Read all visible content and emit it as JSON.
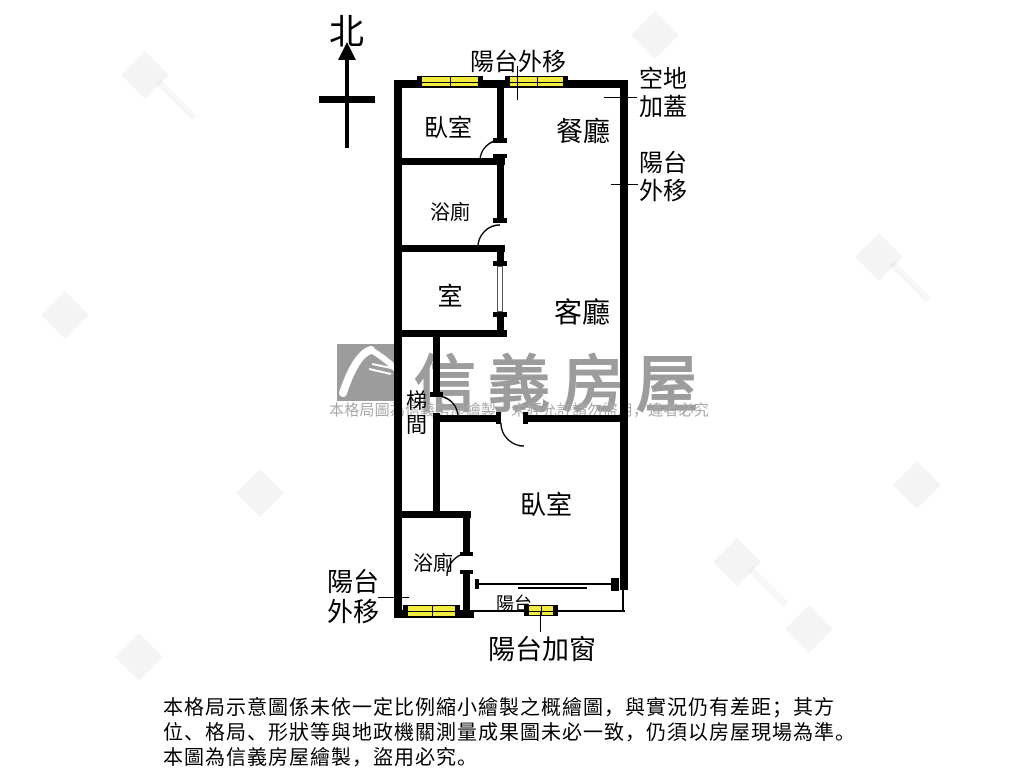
{
  "compass": {
    "north": "北"
  },
  "rooms": {
    "bedroom1": "臥室",
    "dining": "餐廳",
    "bath1": "浴廁",
    "room": "室",
    "living": "客廳",
    "stair": "梯間",
    "bedroom2": "臥室",
    "bath2": "浴廁",
    "balcony": "陽台"
  },
  "annotations": {
    "balcony_out_top": "陽台外移",
    "open_land_cover": "空地加蓋",
    "balcony_out_right": "陽台外移",
    "balcony_out_bottom": "陽台外移",
    "balcony_add_window": "陽台加窗"
  },
  "watermark": {
    "brand": "信義房屋",
    "notice": "本格局圖為信義房屋繪製，未經允許請勿盜用，違者必究"
  },
  "disclaimer": {
    "line1": "本格局示意圖係未依一定比例縮小繪製之概繪圖，與實況仍有差距；其方",
    "line2": "位、格局、形狀等與地政機關測量成果圖未必一致，仍須以房屋現場為準。",
    "line3": "本圖為信義房屋繪製，盜用必究。"
  },
  "colors": {
    "wall": "#000000",
    "window_yellow": "#f3eb3d",
    "watermark_gray": "#9c9c9c"
  }
}
